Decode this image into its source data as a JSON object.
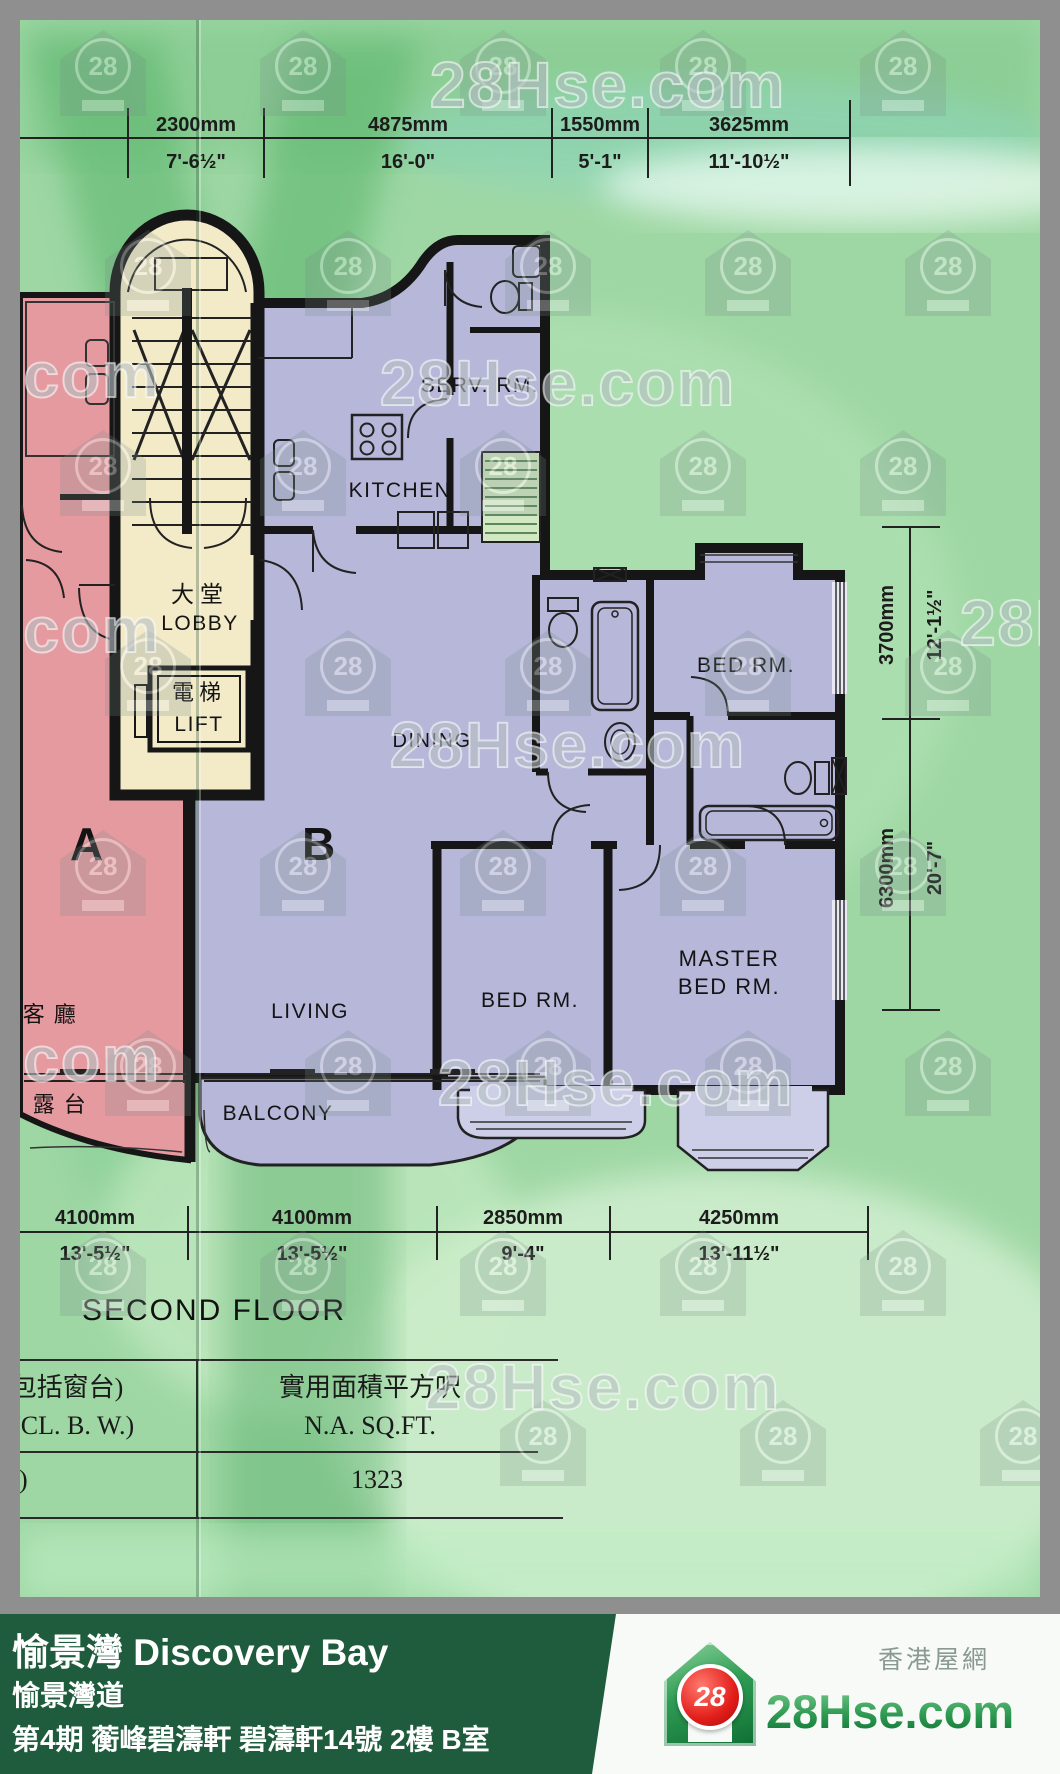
{
  "scan": {
    "floor_title": "SECOND FLOOR",
    "dims": {
      "top_partial": "m",
      "top": [
        {
          "mm": "2300mm",
          "ft": "7'-6½\""
        },
        {
          "mm": "4875mm",
          "ft": "16'-0\""
        },
        {
          "mm": "1550mm",
          "ft": "5'-1\""
        },
        {
          "mm": "3625mm",
          "ft": "11'-10½\""
        }
      ],
      "right": [
        {
          "mm": "3700mm",
          "ft": "12'-1½\""
        },
        {
          "mm": "6300mm",
          "ft": "20'-7\""
        }
      ],
      "bottom": [
        {
          "mm": "4100mm",
          "ft": "13'-5½\""
        },
        {
          "mm": "4100mm",
          "ft": "13'-5½\""
        },
        {
          "mm": "2850mm",
          "ft": "9'-4\""
        },
        {
          "mm": "4250mm",
          "ft": "13'-11½\""
        }
      ]
    },
    "rooms": {
      "unit_a": "A",
      "unit_b": "B",
      "lobby_zh": "大堂",
      "lobby_en": "LOBBY",
      "lift_zh": "電梯",
      "lift_en": "LIFT",
      "kitchen": "KITCHEN",
      "serv_rm": "SERV. RM.",
      "dining": "DINING",
      "bed_rm_top": "BED RM.",
      "bed_rm_mid": "BED RM.",
      "master_line1": "MASTER",
      "master_line2": "BED RM.",
      "living": "LIVING",
      "living_zh": "客 廳",
      "balcony": "BALCONY",
      "balcony_zh": "露 台"
    },
    "area_table": {
      "col1_line1": "(包括窗台)",
      "col1_line2": "NCL. B. W.)",
      "col2_line1": "實用面積平方呎",
      "col2_line2": "N.A. SQ.FT.",
      "row_col1": "3)",
      "row_col2": "1323"
    }
  },
  "watermark": {
    "site_text": "28Hse.com",
    "logo_number": "28"
  },
  "footer": {
    "estate_title": "愉景灣 Discovery Bay",
    "street": "愉景灣道",
    "detail": "第4期 蘅峰碧濤軒 碧濤軒14號 2樓 B室",
    "brand_number": "28",
    "brand_name": "28Hse.com",
    "tagline": "香港屋網"
  }
}
